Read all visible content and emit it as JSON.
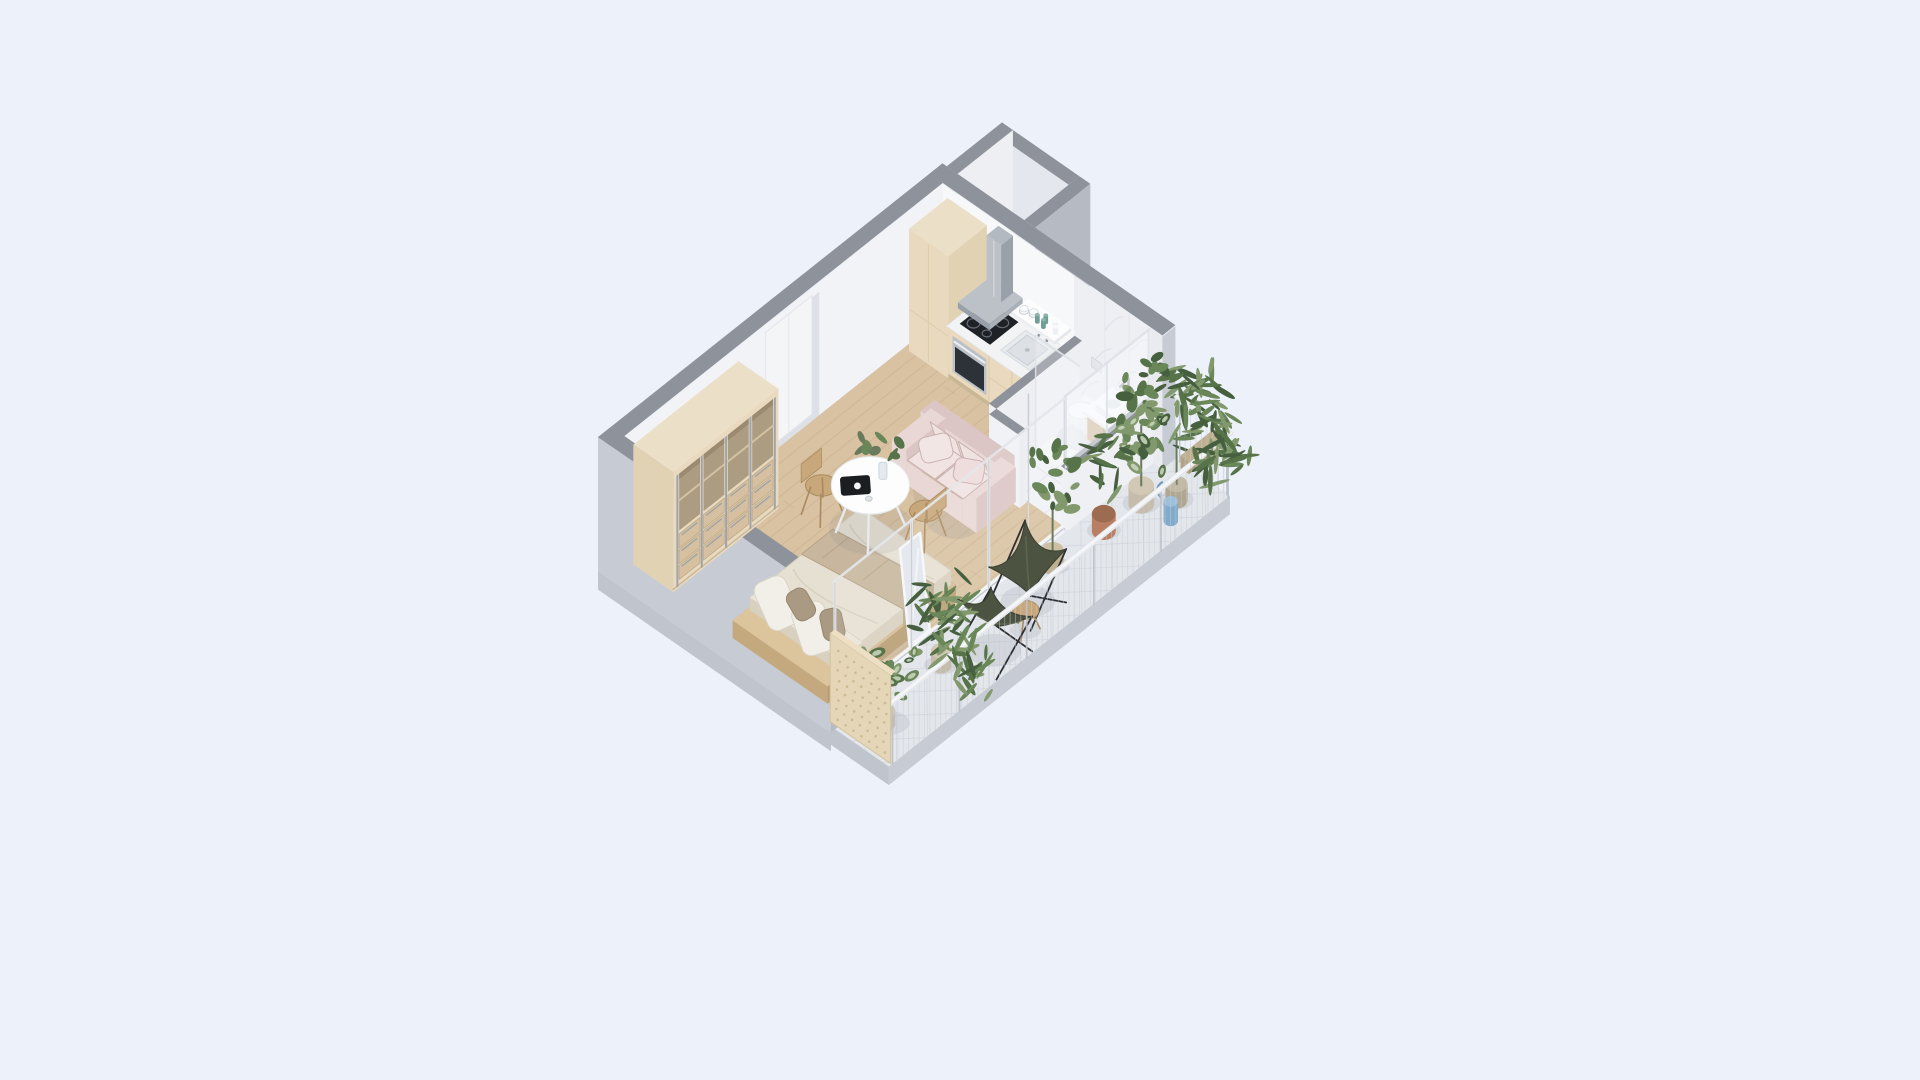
{
  "palette": {
    "bg": "#edf1f9",
    "wallTop": "#8e929a",
    "wallOuter": "#c7cbd3",
    "wallOuterDark": "#b6bac3",
    "slabSide": "#c0c4cc",
    "innerWhite": "#f7f8fa",
    "innerWhiteB": "#f1f3f6",
    "doorPanel": "#f4f5f7",
    "doorJamb": "#dde0e6",
    "marble": "#edeff3",
    "marbleVein": "#ced3dc",
    "marbleFloor": "#f1f2f5",
    "marbleLine": "#dfe2e8",
    "wood": "#d9c2a2",
    "woodLine": "#c6a985",
    "balconyTile": "#e3e6eb",
    "balconyLine": "#d0d5dc",
    "cream": "#ecdfc8",
    "creamSide": "#e2d2b4",
    "creamFront": "#e9d9bf",
    "creamDark": "#d2bd9b",
    "toeKick": "#c9b694",
    "steel": "#bcc1c8",
    "steelDark": "#9aa0a9",
    "chrome": "#8f959d",
    "counter": "#f2f3f5",
    "white": "#fdfdfe",
    "offWhite": "#eceef2",
    "glassFrame": "#dfe2e7",
    "glassTint": "#f6f8fb",
    "black": "#1e2126",
    "ovenGlass": "#2d3138",
    "teal": "#6f9e97",
    "sofa": "#e9d7d5",
    "sofaShade": "#dcc6c5",
    "sofaDark": "#c9b1b0",
    "sofaLight": "#f1e3e2",
    "linen": "#eae5d9",
    "linenShade": "#d8d1c0",
    "duvet": "#e6e0d2",
    "blanket": "#c8b79e",
    "pillow": "#f1efe7",
    "pillowDark": "#aa9a84",
    "bedWood": "#d3ba93",
    "chairWood": "#c8a87a",
    "chairWoodDark": "#a98a60",
    "olive": "#4c5340",
    "oliveDark": "#383e30",
    "oliveHi": "#616a52",
    "leaf1": "#46603f",
    "leaf2": "#567349",
    "leaf3": "#6a8759",
    "leaf4": "#81996c",
    "leafPale": "#c7d4b9",
    "stem": "#6b7a5c",
    "terracotta": "#b97f62",
    "terracottaDark": "#9d co",
    "bluePot": "#82abcb",
    "potGray": "#c6bcab",
    "potBasket": "#bfb091",
    "mirror": "#e2e7ee",
    "shadow": "rgba(95,105,125,0.12)"
  },
  "scene": {
    "type": "isometric-apartment-floorplan-render",
    "rooms": [
      "living-bedroom",
      "kitchen",
      "bathroom",
      "balcony",
      "entry-niche"
    ],
    "objects": [
      "wardrobe",
      "entry-door",
      "tall-cabinet",
      "range-hood",
      "cooktop",
      "oven",
      "kitchen-sink",
      "open-shelf",
      "dishes",
      "wall-hung-toilet",
      "vanity-basin",
      "shower-glass",
      "sofa",
      "dining-table",
      "dining-chairs",
      "double-bed",
      "floor-mirror",
      "sliding-glass-doors",
      "balcony-railing",
      "privacy-panel",
      "butterfly-chairs",
      "side-stool",
      "potted-plants",
      "watering-can"
    ]
  }
}
